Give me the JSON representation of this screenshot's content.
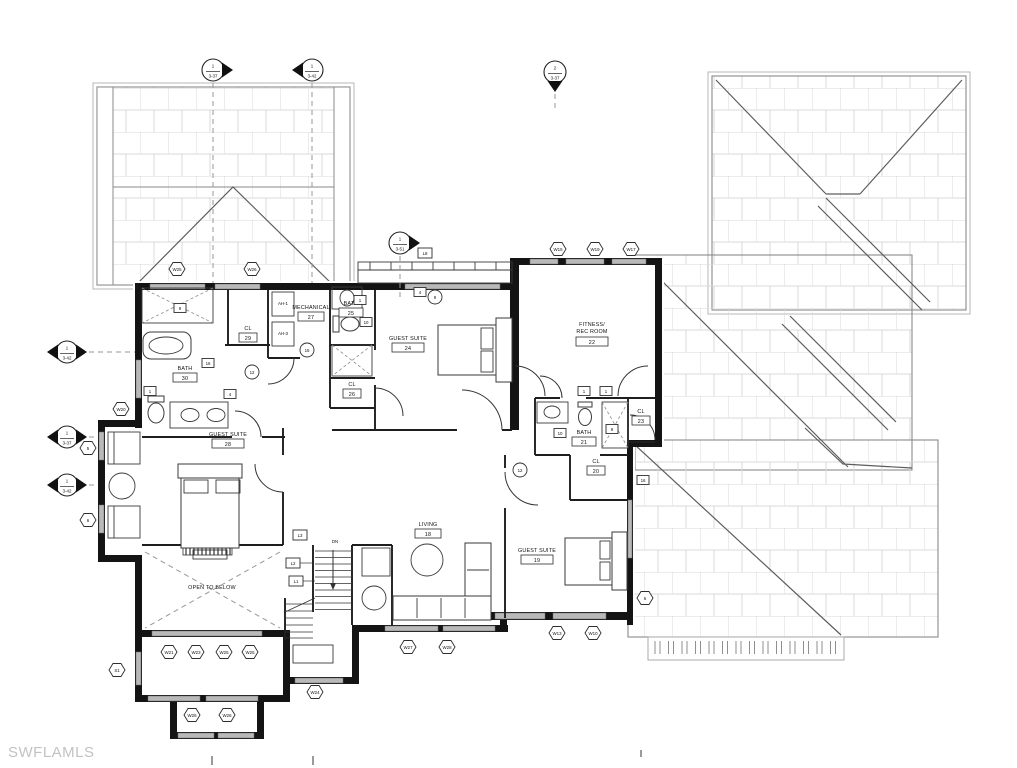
{
  "watermark": "SWFLAMLS",
  "plan": {
    "rooms": [
      {
        "name": "BATH",
        "number": "30"
      },
      {
        "name": "CL",
        "number": "29"
      },
      {
        "name": "MECHANICAL",
        "number": "27"
      },
      {
        "name": "BATH",
        "number": "25"
      },
      {
        "name": "CL",
        "number": "26"
      },
      {
        "name": "GUEST SUITE",
        "number": "24"
      },
      {
        "name": "FITNESS/",
        "name2": "REC ROOM",
        "number": "22"
      },
      {
        "name": "CL",
        "number": "23"
      },
      {
        "name": "BATH",
        "number": "21"
      },
      {
        "name": "CL",
        "number": "20"
      },
      {
        "name": "GUEST SUITE",
        "number": "19"
      },
      {
        "name": "LIVING",
        "number": "18"
      },
      {
        "name": "GUEST SUITE",
        "number": "28"
      },
      {
        "name": "OPEN TO BELOW",
        "number": ""
      }
    ],
    "stair_label": "DN",
    "equipment": [
      "AH-1",
      "AH-3"
    ]
  },
  "markers": [
    {
      "top": "1",
      "sheet": "3-37"
    },
    {
      "top": "1",
      "sheet": "3-42"
    },
    {
      "top": "2",
      "sheet": "3-37"
    },
    {
      "top": "1",
      "sheet": "3-51"
    },
    {
      "top": "1",
      "sheet": "3-42"
    },
    {
      "top": "1",
      "sheet": "3-37"
    },
    {
      "top": "1",
      "sheet": "3-42"
    }
  ],
  "window_tags": [
    "W25",
    "W26",
    "W15",
    "W19",
    "W17",
    "W20",
    "5",
    "6",
    "W27",
    "W28",
    "W13",
    "W10",
    "W21",
    "W23",
    "W25",
    "W25",
    "W26",
    "W26",
    "W24",
    "6",
    "S1"
  ],
  "door_tags": [
    "9",
    "16",
    "1",
    "4",
    "10",
    "1",
    "10",
    "9",
    "16",
    "4",
    "1",
    "1"
  ],
  "stair_tags": [
    "L3",
    "L2",
    "L1",
    "L8"
  ],
  "circle_tags": [
    "12",
    "15",
    "9",
    "12"
  ],
  "colors": {
    "wall": "#141414",
    "roof_line": "#8a8a8a",
    "hatch": "#d9d9d9",
    "window_fill": "#b9b9b9",
    "watermark": "#c2c2c2"
  }
}
